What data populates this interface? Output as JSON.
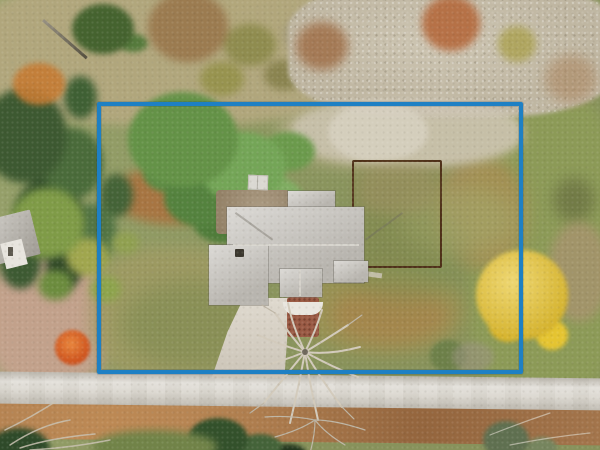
{
  "image": {
    "kind": "aerial-drone-photograph",
    "subject": "single-family home lot outlined with a property-boundary overlay, autumn season",
    "width_px": 600,
    "height_px": 450
  },
  "boundary_overlay": {
    "shape": "rectangle",
    "stroke_color": "#1e80c4",
    "stroke_px": 4
  },
  "colors": {
    "lawn": "#8f9a60",
    "field_grass": "#b2a77b",
    "conifer_foliage": "#3d5931",
    "deciduous_green": "#649247",
    "bare_canopy": "#c3bba8",
    "autumn_yellow": "#e7c636",
    "autumn_orange": "#c57b33",
    "autumn_red": "#dd5520",
    "leaf_litter": "#a87a50",
    "dirt": "#ad6d3a",
    "road_pavement": "#d6d2c9",
    "house_roof": "#cbc8c2",
    "chimney": "#3b372e",
    "driveway": "#d8d1c4",
    "patio": "#a08d71",
    "shed_roof": "#dad8d2",
    "garden_fence": "#4e3018",
    "brick_walk": "#9a5a44",
    "stoop": "#e9e6df",
    "neighbor_roof": "#b7b3ab",
    "neighbor_wall": "#e7e4de"
  }
}
